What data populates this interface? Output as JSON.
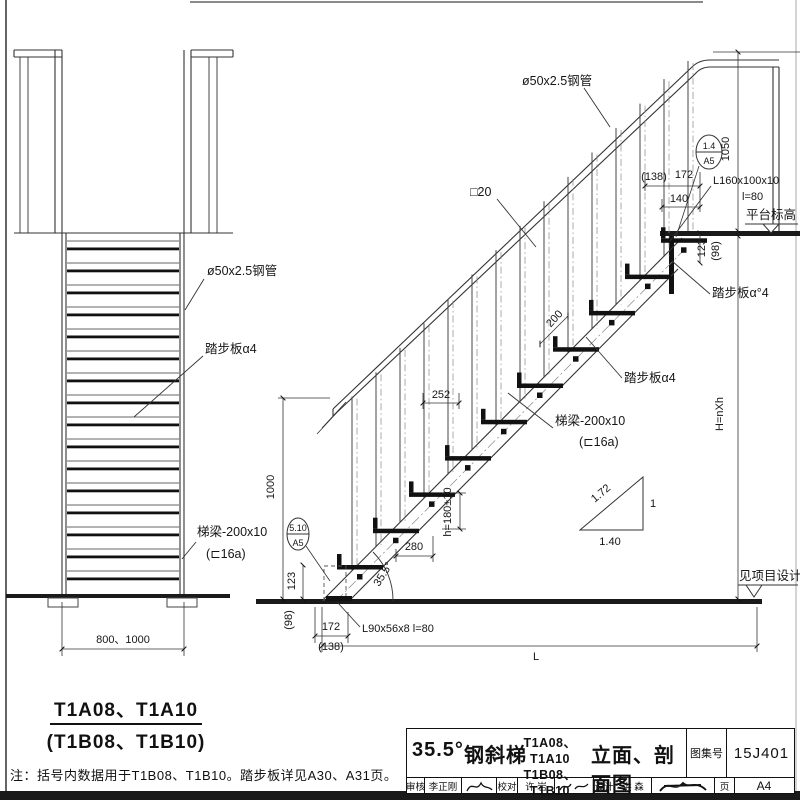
{
  "sheet": {
    "note": "注：括号内数据用于T1B08、T1B10。踏步板详见A30、A31页。"
  },
  "front_view": {
    "caption_line1": "T1A08、T1A10",
    "caption_line2": "(T1B08、T1B10)",
    "label_pipe": "ø50x2.5钢管",
    "label_tread": "踏步板α4",
    "label_stringer_1": "梯梁-200x10",
    "label_stringer_2": "(⊏16a)",
    "dim_width": "800、1000"
  },
  "section_view": {
    "label_pipe": "ø50x2.5钢管",
    "label_baluster": "□20",
    "label_tread_mid": "踏步板α4",
    "label_tread_top": "踏步板α°4",
    "label_stringer_1": "梯梁-200x10",
    "label_stringer_2": "(⊏16a)",
    "label_angle_top_1": "L160x100x10",
    "label_angle_top_2": "l=80",
    "label_angle_bottom": "L90x56x8  l=80",
    "label_platform_level": "平台标高",
    "label_ground_level": "见项目设计",
    "detail_top_num": "1.4",
    "detail_top_sheet": "A5",
    "detail_bottom_num": "5.10",
    "detail_bottom_sheet": "A5",
    "dim_1050": "1050",
    "dim_138_top": "(138)",
    "dim_172_top": "172",
    "dim_140": "140",
    "dim_123_top": "123",
    "dim_98_top": "(98)",
    "dim_200": "200",
    "dim_252": "252",
    "dim_1000": "1000",
    "dim_123_bottom": "123",
    "dim_98_bottom": "(98)",
    "dim_172_bottom": "172",
    "dim_138_bottom": "(138)",
    "dim_280": "280",
    "dim_tread_rise": "h=180±10",
    "dim_angle": "35.5°",
    "dim_span": "L",
    "dim_height": "H=nXh",
    "slope_run": "1.40",
    "slope_rise": "1",
    "slope_hyp": "1.72"
  },
  "title_block": {
    "angle": "35.5°",
    "product": "钢斜梯",
    "models_line1": "T1A08、T1A10",
    "models_line2": "T1B08、T1B10",
    "drawing_type": "立面、剖面图",
    "atlas_label": "图集号",
    "atlas_number": "15J401",
    "page_label": "页",
    "page_number": "A4",
    "review_label": "审核",
    "reviewer": "李正刚",
    "check_label": "校对",
    "checker": "许 岩",
    "design_label": "设计",
    "designer": "洪 森"
  }
}
